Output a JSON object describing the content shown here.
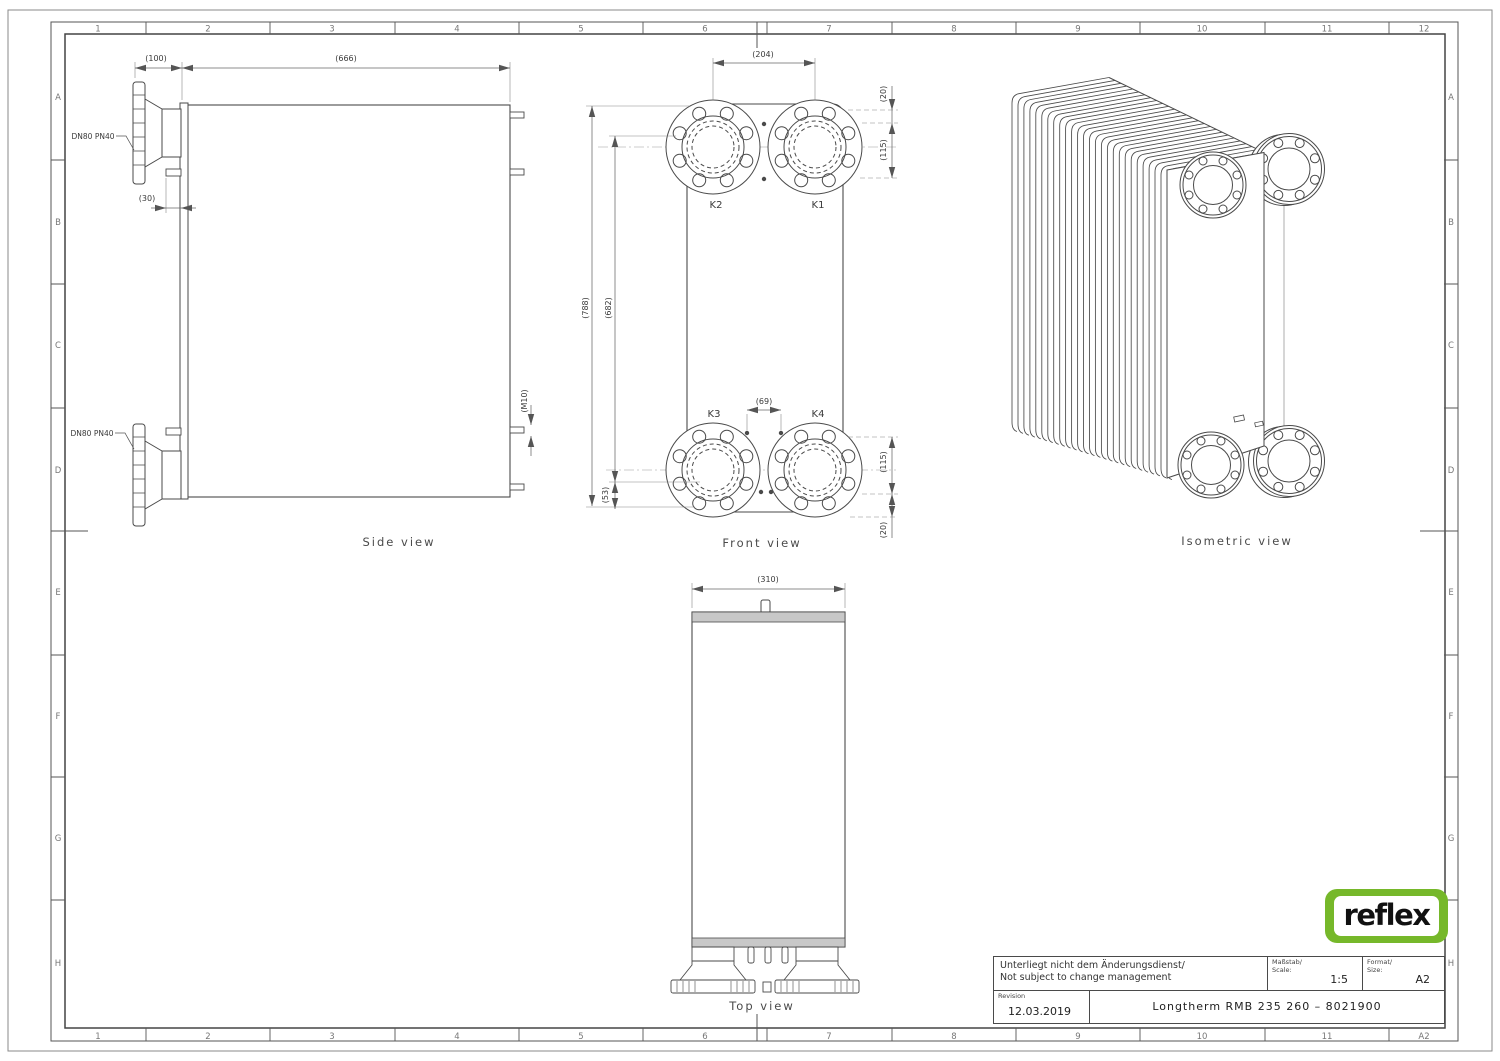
{
  "drawing": {
    "border": {
      "columns_top": [
        "1",
        "2",
        "3",
        "4",
        "5",
        "6",
        "7",
        "8",
        "9",
        "10",
        "11",
        "12"
      ],
      "columns_bottom": [
        "1",
        "2",
        "3",
        "4",
        "5",
        "6",
        "7",
        "8",
        "9",
        "10",
        "11",
        "A2"
      ],
      "rows": [
        "A",
        "B",
        "C",
        "D",
        "E",
        "F",
        "G",
        "H"
      ]
    },
    "side_view": {
      "label": "Side view",
      "nozzle_top_label": "DN80 PN40",
      "nozzle_bottom_label": "DN80 PN40",
      "dim_flange_depth": "(100)",
      "dim_length": "(666)",
      "dim_stud": "(30)",
      "dim_thread": "(M10)"
    },
    "front_view": {
      "label": "Front view",
      "port_k1": "K1",
      "port_k2": "K2",
      "port_k3": "K3",
      "port_k4": "K4",
      "dim_port_h_spacing": "(204)",
      "dim_top_offset": "(20)",
      "dim_port_v": "(115)",
      "dim_total_height": "(788)",
      "dim_port_height": "(682)",
      "dim_stud_spacing": "(69)",
      "dim_bottom_stud": "(53)",
      "dim_port_v_bottom": "(115)",
      "dim_bottom_offset": "(20)"
    },
    "top_view": {
      "label": "Top view",
      "dim_width": "(310)"
    },
    "iso_view": {
      "label": "Isometric view"
    },
    "title_block": {
      "note_line1": "Unterliegt nicht dem Änderungsdienst/",
      "note_line2": "Not subject to change management",
      "scale_label_de": "Maßstab/",
      "scale_label_en": "Scale:",
      "scale_value": "1:5",
      "format_label_de": "Format/",
      "format_label_en": "Size:",
      "format_value": "A2",
      "revision_label": "Revision",
      "revision_date": "12.03.2019",
      "title": "Longtherm RMB 235 260 – 8021900"
    },
    "logo": {
      "text": "reflex",
      "color": "#76b82a"
    }
  }
}
